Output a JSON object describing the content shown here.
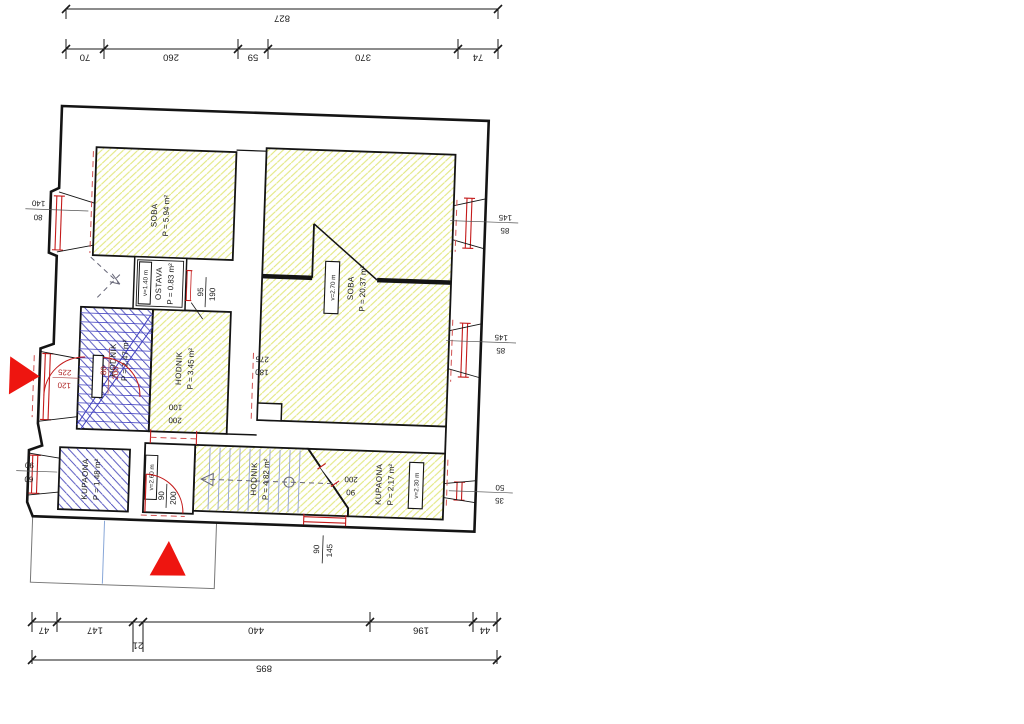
{
  "sheet": {
    "type": "floor-plan-drawing"
  },
  "colors": {
    "wall": "#141414",
    "window_red": "#c41a1a",
    "dashed_red": "#d05050",
    "hatch_yellow": "#e2e77f",
    "hatch_blue": "#4545ba",
    "tread_blue": "#8f9fd6",
    "marker_red": "#ee1510",
    "porch_line": "#777777",
    "porch_blue": "#88a7d8"
  },
  "dims": {
    "top_total": "827",
    "top_segments": [
      "70",
      "260",
      "59",
      "370",
      "74"
    ],
    "bottom_segments": [
      "47",
      "147",
      "21",
      "440",
      "196",
      "44"
    ],
    "bottom_total": "895"
  },
  "rooms": {
    "soba1": {
      "name": "SOBA",
      "area": "P = 5.94 m²"
    },
    "soba2": {
      "name": "SOBA",
      "area": "P = 20.37 m²",
      "height": "v=2.70 m"
    },
    "ostava": {
      "name": "OSTAVA",
      "area": "P = 0.83 m²",
      "height": "v=1.40 m"
    },
    "hodnik1": {
      "name": "HODNIK",
      "area": "P = 2.47 m²"
    },
    "hodnik2": {
      "name": "HODNIK",
      "area": "P = 3.45 m²"
    },
    "kupaona1": {
      "name": "KUPAONA",
      "area": "P = 1.48 m²"
    },
    "hodnik3": {
      "name": "HODNIK",
      "area": "P = 4.82 m²"
    },
    "kupaona2": {
      "name": "KUPAONA",
      "area": "P = 2.17 m²",
      "height": "v=2.30 m"
    },
    "vestibule": {
      "height": "v=2.60 m"
    }
  },
  "openings": {
    "win_left_top": {
      "line1": "140",
      "line2": "80"
    },
    "door_left_mid": {
      "line1": "225",
      "line2": "120"
    },
    "win_left_bottom": {
      "line1": "90",
      "line2": "60"
    },
    "win_right_top": {
      "line1": "145",
      "line2": "85"
    },
    "win_right_mid": {
      "line1": "145",
      "line2": "85"
    },
    "win_right_bottom": {
      "line1": "50",
      "line2": "35"
    },
    "win_bottom": {
      "line1": "90",
      "line2": "145"
    },
    "door_ostava": {
      "line1": "95",
      "line2": "190"
    },
    "door_stairs": {
      "line1": "80",
      "line2": "200"
    },
    "door_hodnik": {
      "line1": "100",
      "line2": "200"
    },
    "door_entry": {
      "line1": "90",
      "line2": "200"
    },
    "door_kupaona2": {
      "line1": "200",
      "line2": "90"
    },
    "opening_soba2": {
      "line1": "275",
      "line2": "180"
    }
  }
}
